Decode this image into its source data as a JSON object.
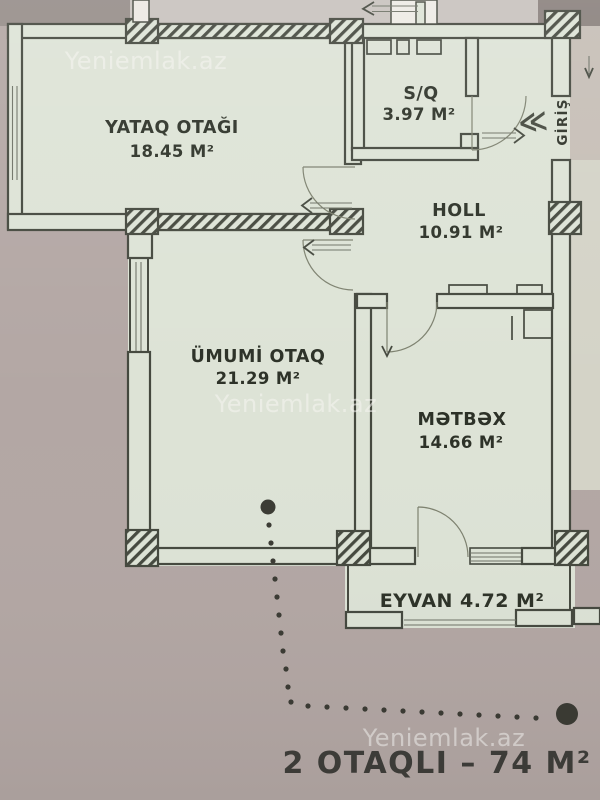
{
  "watermark": {
    "text": "Yeniemlak.az"
  },
  "rooms": {
    "bedroom": {
      "name": "YATAQ OTAĞI",
      "area": "18.45 M²"
    },
    "bathroom": {
      "name": "S/Q",
      "area": "3.97 M²"
    },
    "hall": {
      "name": "HOLL",
      "area": "10.91 M²"
    },
    "living": {
      "name": "ÜMUMİ OTAQ",
      "area": "21.29 M²"
    },
    "kitchen": {
      "name": "MƏTBƏX",
      "area": "14.66 M²"
    },
    "balcony": {
      "label": "EYVAN 4.72 M²"
    }
  },
  "entrance": {
    "label": "GİRİŞ",
    "chevrons": "≪"
  },
  "caption": {
    "text": "2 OTAQLI – 74 M²"
  },
  "colors": {
    "background": "#b3a7a4",
    "plan_fill": "#dde3d6",
    "wall": "#44483e",
    "label_ink": "#2c3127",
    "caption_ink": "#3e3d39",
    "watermark": "#f7f6f3",
    "top_strip": "#c8c2be",
    "grey_corner": "#968d89",
    "dark_corner": "#8a817d",
    "adjacent_area": "#d4d3c7",
    "entrance_outside": "#c6beb6",
    "dot": "#3a3a33"
  }
}
